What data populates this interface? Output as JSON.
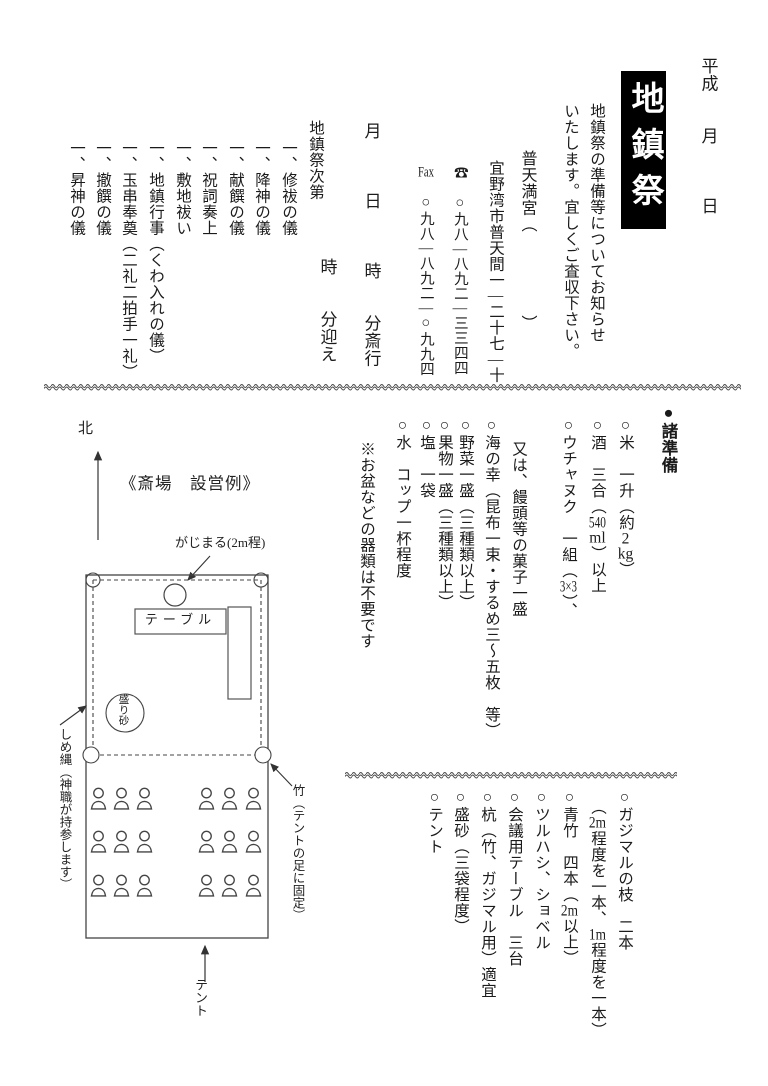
{
  "header": {
    "date_line": "平成　　月　　　日",
    "title": "地鎮祭",
    "intro_line1": "地鎮祭の準備等についてお知らせ",
    "intro_line2": "いたします。宜しくご査収下さい。",
    "shrine": {
      "name": "普天満宮（　　　　　）",
      "address": "宜野湾市普天間一[[―]]二十七[[―]]十",
      "tel": "☎　○九八[[―]]八九二[[―]]三三四四",
      "fax": "[[Fax]]　○九八[[―]]八九二[[―]]○九九四"
    },
    "schedule_line1": "月　　　日　　　時　　分斎行",
    "schedule_line2": "時　　分迎え"
  },
  "ceremony": {
    "header": "地鎮祭次第",
    "items": [
      "一、修祓の儀",
      "一、降神の儀",
      "一、献饌の儀",
      "一、祝詞奏上",
      "一、敷地祓い",
      "一、地鎮行事（くわ入れの儀）",
      "一、玉串奉奠（二礼二拍手一礼）",
      "一、撤饌の儀",
      "一、昇神の儀"
    ]
  },
  "preparations": {
    "header": "●諸準備",
    "items": [
      "○米　一升（約[[2]][[kg]]）",
      "○酒　三合（[[540]][[ml]]）以上",
      "○ウチャヌク　一組（[[3×3]]）、",
      "又は、饅頭等の菓子一盛",
      "○海の幸（昆布一束・するめ三～五枚　等）",
      "○野菜一盛（三種類以上）",
      "○果物一盛（三種類以上）",
      "○塩　一袋",
      "○水　コップ一杯程度",
      "※お盆などの器類は不要です"
    ]
  },
  "equipment": {
    "items": [
      "○ガジマルの枝　二本",
      "（[[2m]]程度を一本、[[1m]]程度を一本）",
      "○青竹　四本（[[2m]]以上）",
      "○ツルハシ、ショベル",
      "○会議用テーブル　三台",
      "○杭（竹、ガジマル用）適宜",
      "○盛砂（三袋程度）",
      "○テント"
    ]
  },
  "diagram": {
    "north": "北",
    "title": "《斎場　設営例》",
    "gajumaru_label": "がじまる(2m程)",
    "table_label": "テーブル",
    "mound_label": "盛り砂",
    "rope_label": "しめ縄（神職が持参します）",
    "bamboo_label": "竹（テントの足に固定）",
    "tent_label": "テント"
  }
}
